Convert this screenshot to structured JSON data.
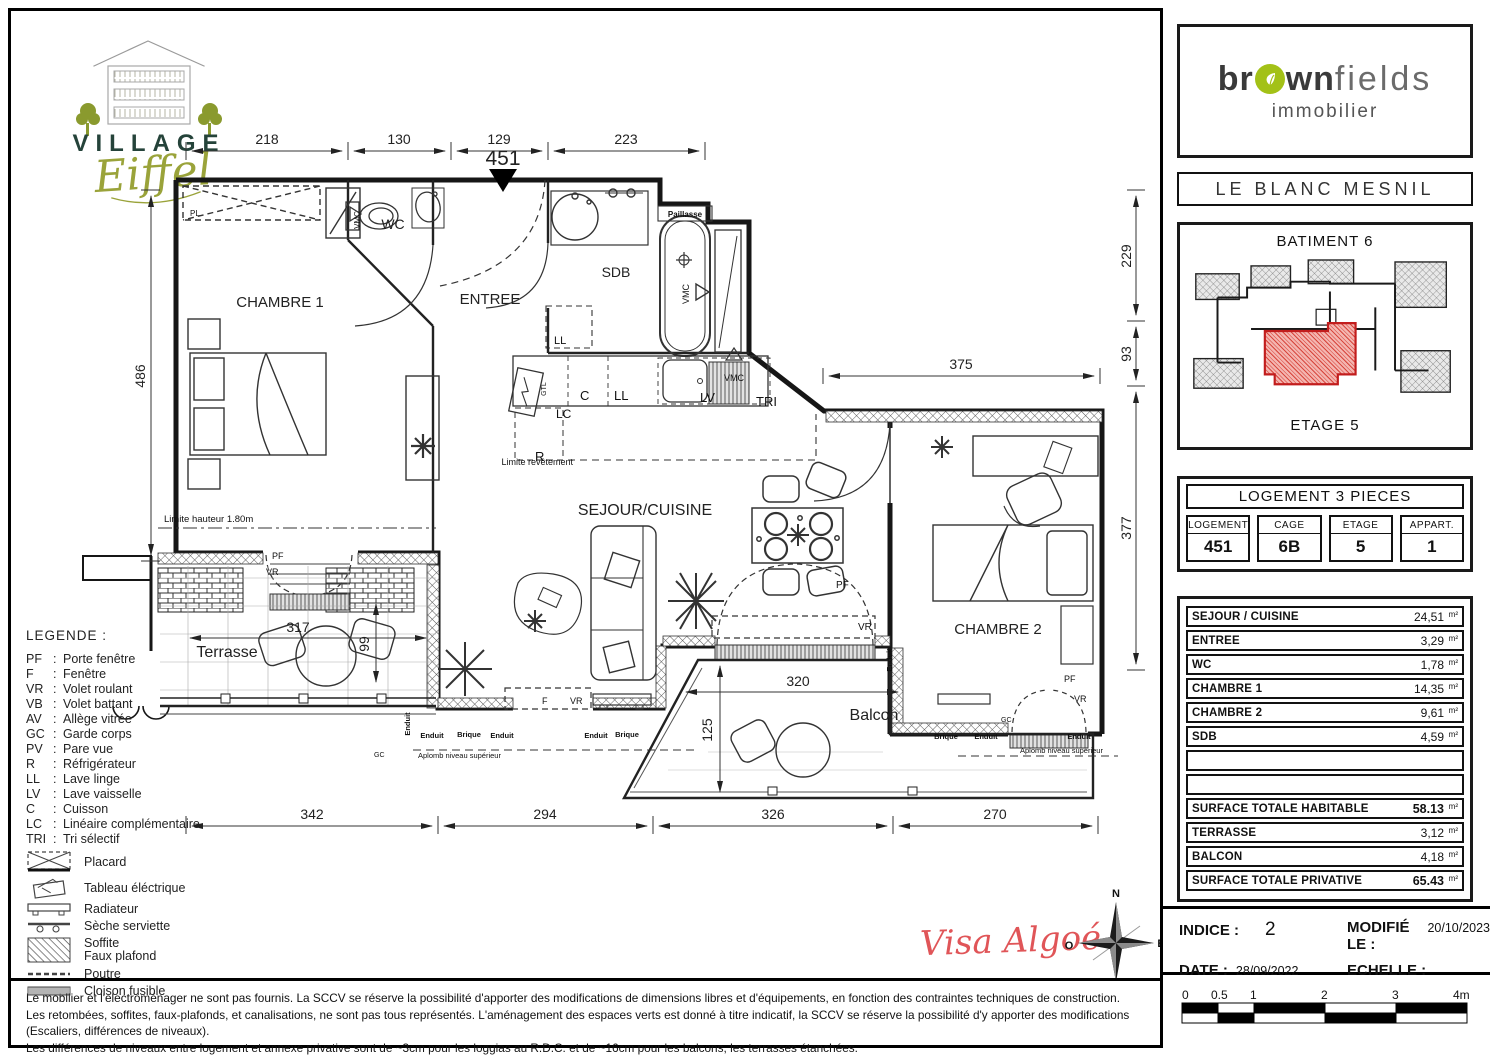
{
  "logo": {
    "name": "VILLAGE",
    "script": "Eiffel"
  },
  "brand": {
    "b1": "br",
    "b2": "wn",
    "thin": "fields",
    "sub": "immobilier",
    "accent": "#a3c117"
  },
  "project": {
    "city": "LE  BLANC  MESNIL",
    "batiment": "BATIMENT 6",
    "etage": "ETAGE 5"
  },
  "unit": {
    "title": "LOGEMENT 3 PIECES",
    "cells": [
      {
        "h": "LOGEMENT",
        "v": "451"
      },
      {
        "h": "CAGE",
        "v": "6B"
      },
      {
        "h": "ETAGE",
        "v": "5"
      },
      {
        "h": "APPART.",
        "v": "1"
      }
    ]
  },
  "areas": {
    "unit": "m²",
    "rows": [
      {
        "label": "SEJOUR  / CUISINE",
        "value": "24,51"
      },
      {
        "label": "ENTREE",
        "value": "3,29"
      },
      {
        "label": "WC",
        "value": "1,78"
      },
      {
        "label": "CHAMBRE 1",
        "value": "14,35"
      },
      {
        "label": "CHAMBRE 2",
        "value": "9,61"
      },
      {
        "label": "SDB",
        "value": "4,59"
      },
      {
        "label": "",
        "value": ""
      },
      {
        "label": "",
        "value": ""
      },
      {
        "label": "SURFACE TOTALE HABITABLE",
        "value": "58.13"
      },
      {
        "label": "TERRASSE",
        "value": "3,12"
      },
      {
        "label": "BALCON",
        "value": "4,18"
      },
      {
        "label": "SURFACE TOTALE PRIVATIVE",
        "value": "65.43"
      }
    ]
  },
  "meta": {
    "indice_label": "INDICE :",
    "indice_value": "2",
    "modified_label": "MODIFIÉ LE :",
    "modified_value": "20/10/2023",
    "date_label": "DATE :",
    "date_value": "28/09/2022",
    "scale_label": "ECHELLE :"
  },
  "scalebar": {
    "t0": "0",
    "t05": "0.5",
    "t1": "1",
    "t2": "2",
    "t3": "3",
    "t4": "4m"
  },
  "visa": {
    "text": "Visa Algoé"
  },
  "compass": {
    "n": "N",
    "e": "E",
    "s": "S",
    "o": "O"
  },
  "legend": {
    "title": "LEGENDE  :",
    "abbr": [
      {
        "k": "PF",
        "v": "Porte fenêtre"
      },
      {
        "k": "F",
        "v": "Fenêtre"
      },
      {
        "k": "VR",
        "v": "Volet roulant"
      },
      {
        "k": "VB",
        "v": "Volet battant"
      },
      {
        "k": "AV",
        "v": "Allège vitrée"
      },
      {
        "k": "GC",
        "v": "Garde corps"
      },
      {
        "k": "PV",
        "v": "Pare vue"
      },
      {
        "k": "R",
        "v": "Réfrigérateur"
      },
      {
        "k": "LL",
        "v": "Lave linge"
      },
      {
        "k": "LV",
        "v": "Lave vaisselle"
      },
      {
        "k": "C",
        "v": "Cuisson"
      },
      {
        "k": "LC",
        "v": "Linéaire complémentaire"
      },
      {
        "k": "TRI",
        "v": "Tri sélectif"
      }
    ],
    "symbols": [
      {
        "label": "Placard"
      },
      {
        "label": "Tableau éléctrique"
      },
      {
        "label": "Radiateur"
      },
      {
        "label": "Sèche serviette"
      },
      {
        "label": "Soffite",
        "label2": "Faux plafond"
      },
      {
        "label": "Poutre"
      },
      {
        "label": "Cloison fusible"
      }
    ]
  },
  "disclaimer": {
    "l1": "Le mobilier et l'electroménager ne sont pas fournis. La SCCV se réserve la possibilité d'apporter des modifications de dimensions libres  et d'équipements, en fonction des contraintes techniques de construction.",
    "l2": "Les retombées, soffites, faux-plafonds, et canalisations, ne sont pas tous représentés. L'aménagement des espaces verts est donné à titre indicatif, la SCCV se réserve la possibilité d'y apporter des modifications (Escaliers, différences de niveaux).",
    "l3": "Les différences de niveaux entre logement et annexe privative sont de ~3cm pour les loggias au R.D.C. et de ~16cm pour les balcons, les terrasses étanchées."
  },
  "plan": {
    "rooms": {
      "chambre1": "CHAMBRE 1",
      "wc": "WC",
      "entree": "ENTREE",
      "sdb": "SDB",
      "sejour": "SEJOUR/CUISINE",
      "chambre2": "CHAMBRE 2",
      "terrasse": "Terrasse",
      "balcon": "Balcon"
    },
    "dims": {
      "t1": "218",
      "t2": "130",
      "t3": "129",
      "t4": "223",
      "left": "486",
      "r1": "229",
      "r2": "93",
      "r3": "377",
      "b1": "342",
      "b2": "294",
      "b3": "326",
      "b4": "270",
      "i375": "375",
      "i317": "317",
      "i99": "99",
      "i320": "320",
      "i125": "125"
    },
    "ann": {
      "num": "451",
      "paillasse": "Paillasse",
      "vmc": "VMC",
      "gtl": "GTL",
      "pl": "PL",
      "limite_h": "Limite hauteur 1.80m",
      "limite_r": "Limite revêtement",
      "aplomb": "Aplomb niveau supérieur",
      "enduit": "Enduit",
      "brique": "Brique",
      "gc": "GC",
      "pf": "PF",
      "vr": "VR",
      "f": "F",
      "c": "C",
      "ll": "LL",
      "lv": "LV",
      "lc": "LC",
      "r": "R",
      "tri": "TRI"
    }
  }
}
